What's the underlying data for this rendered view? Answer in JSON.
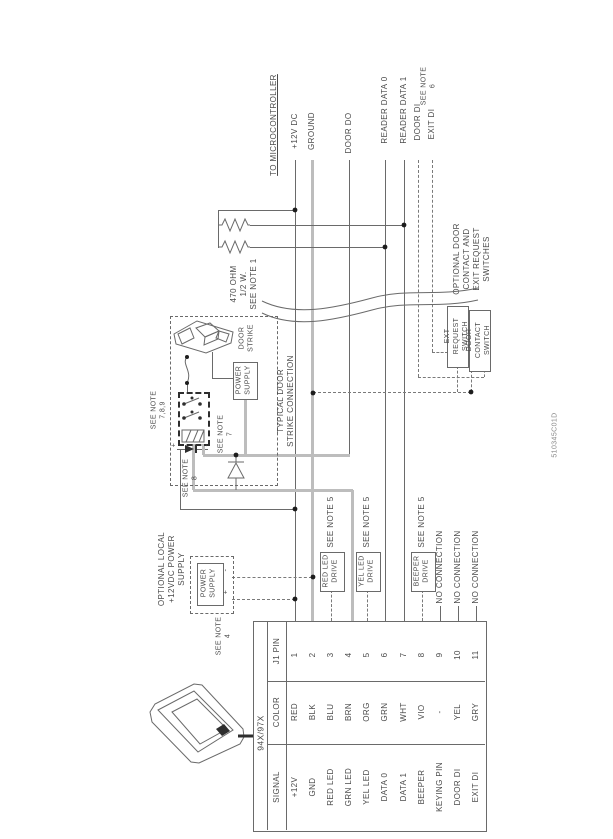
{
  "drawing_number": "510345C01D",
  "microcontroller": {
    "heading": "TO MICROCONTROLLER",
    "signals": [
      "+12V DC",
      "GROUND",
      "DOOR DO",
      "READER DATA 0",
      "READER DATA 1",
      "DOOR DI",
      "EXIT DI"
    ],
    "exit_di_note": "SEE NOTE\n6"
  },
  "resistors": {
    "label": "470 OHM\n1/2 W.\nSEE NOTE 1"
  },
  "switches": {
    "group_label": "OPTIONAL DOOR\nCONTACT AND\nEXIT REQUEST\nSWITCHES",
    "exit_request": "EXT\nREQUEST\nSWITCH",
    "door_contact": "DOOR\nCONTACT\nSWITCH"
  },
  "strike": {
    "group_label": "TYPICAL DOOR\nSTRIKE CONNECTION",
    "door_strike": "DOOR\nSTRIKE",
    "power_supply": "POWER\nSUPPLY",
    "note_789": "SEE NOTE\n7,8,9",
    "note_7": "SEE NOTE\n7",
    "note_8": "SEE NOTE\n8",
    "plus": "+",
    "minus": "-"
  },
  "optional_supply": {
    "group_label": "OPTIONAL LOCAL\n+12VDC POWER\nSUPPLY",
    "power_supply": "POWER\nSUPPLY",
    "note_4": "SEE NOTE\n4",
    "plus": "+",
    "minus": "-"
  },
  "drive_circuits": [
    {
      "label": "RED LED\nDRIVE",
      "note": "SEE NOTE 5"
    },
    {
      "label": "YEL LED\nDRIVE",
      "note": "SEE NOTE 5"
    },
    {
      "label": "BEEPER\nDRIVE",
      "note": "SEE NOTE 5"
    }
  ],
  "no_connection": [
    "NO CONNECTION",
    "NO CONNECTION",
    "NO CONNECTION"
  ],
  "reader_table": {
    "model": "94X/97X",
    "col_headers": {
      "signal": "SIGNAL",
      "color": "COLOR",
      "pin": "J1 PIN"
    },
    "rows": [
      {
        "pin": "1",
        "color": "RED",
        "signal": "+12V"
      },
      {
        "pin": "2",
        "color": "BLK",
        "signal": "GND"
      },
      {
        "pin": "3",
        "color": "BLU",
        "signal": "RED LED"
      },
      {
        "pin": "4",
        "color": "BRN",
        "signal": "GRN LED"
      },
      {
        "pin": "5",
        "color": "ORG",
        "signal": "YEL LED"
      },
      {
        "pin": "6",
        "color": "GRN",
        "signal": "DATA 0"
      },
      {
        "pin": "7",
        "color": "WHT",
        "signal": "DATA 1"
      },
      {
        "pin": "8",
        "color": "VIO",
        "signal": "BEEPER"
      },
      {
        "pin": "9",
        "color": "-",
        "signal": "KEYING PIN"
      },
      {
        "pin": "10",
        "color": "YEL",
        "signal": "DOOR DI"
      },
      {
        "pin": "11",
        "color": "GRY",
        "signal": "EXIT DI"
      }
    ]
  }
}
